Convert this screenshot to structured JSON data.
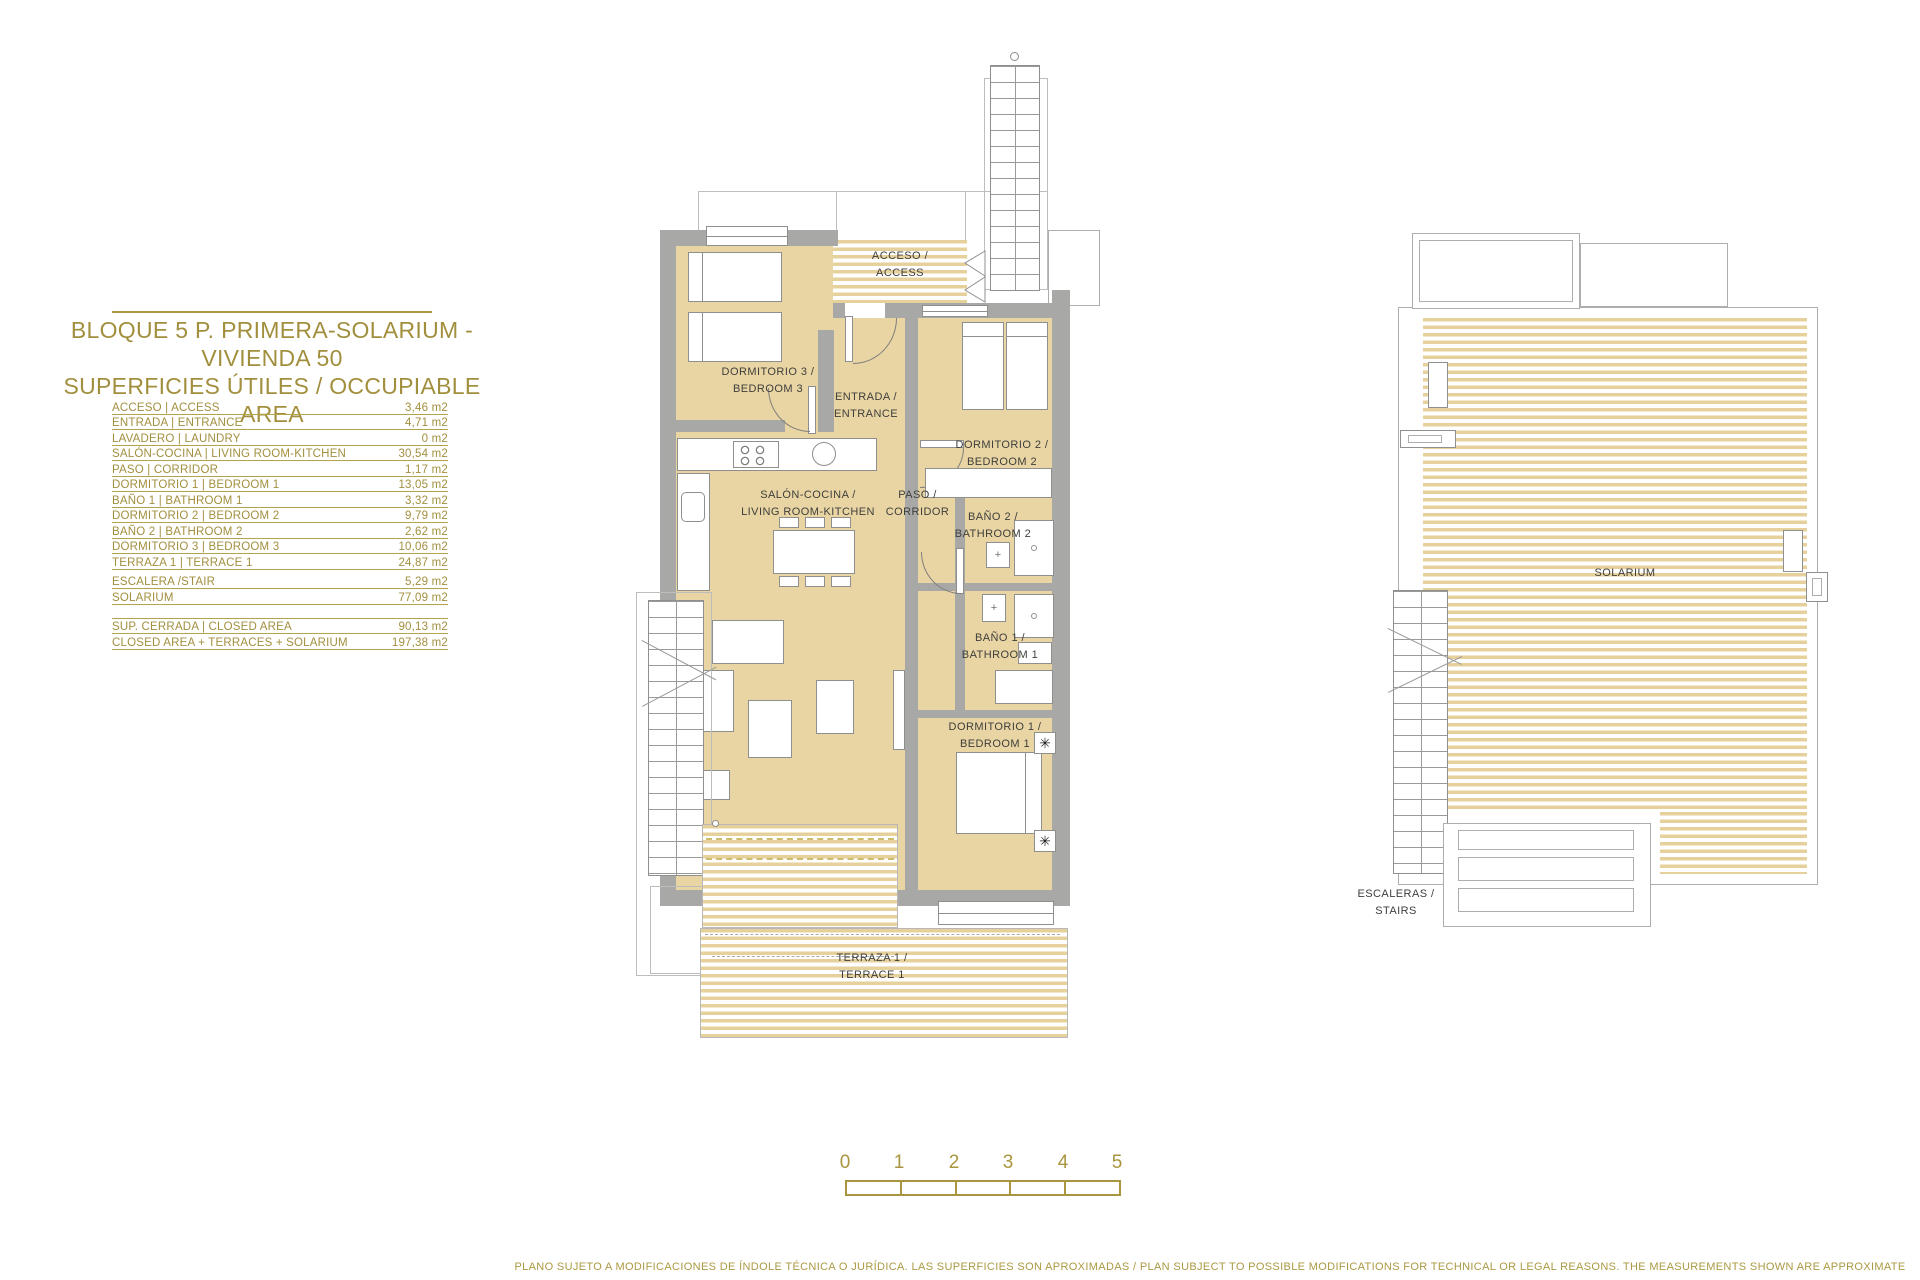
{
  "title": {
    "line1": "BLOQUE 5 P. PRIMERA-SOLARIUM - VIVIENDA 50",
    "line2": "SUPERFICIES ÚTILES / OCCUPIABLE AREA"
  },
  "area_table": {
    "rows": [
      {
        "label": "ACCESO | ACCESS",
        "value": "3,46 m2"
      },
      {
        "label": "ENTRADA | ENTRANCE",
        "value": "4,71 m2"
      },
      {
        "label": "LAVADERO | LAUNDRY",
        "value": "0 m2"
      },
      {
        "label": "SALÓN-COCINA | LIVING ROOM-KITCHEN",
        "value": "30,54 m2"
      },
      {
        "label": "PASO | CORRIDOR",
        "value": "1,17 m2"
      },
      {
        "label": "DORMITORIO 1 | BEDROOM 1",
        "value": "13,05 m2"
      },
      {
        "label": "BAÑO 1 | BATHROOM 1",
        "value": "3,32 m2"
      },
      {
        "label": "DORMITORIO 2 | BEDROOM 2",
        "value": "9,79 m2"
      },
      {
        "label": "BAÑO 2 | BATHROOM 2",
        "value": "2,62 m2"
      },
      {
        "label": "DORMITORIO 3 | BEDROOM 3",
        "value": "10,06 m2"
      },
      {
        "label": "TERRAZA 1 | TERRACE 1",
        "value": "24,87 m2"
      },
      {
        "label": "ESCALERA /STAIR",
        "value": "5,29 m2"
      },
      {
        "label": "SOLARIUM",
        "value": "77,09 m2"
      }
    ],
    "totals": [
      {
        "label": "SUP. CERRADA | CLOSED AREA",
        "value": "90,13 m2"
      },
      {
        "label": "CLOSED AREA + TERRACES + SOLARIUM",
        "value": "197,38 m2"
      }
    ]
  },
  "floor_plan": {
    "rooms": {
      "acceso": {
        "l1": "ACCESO /",
        "l2": "ACCESS"
      },
      "dormitorio3": {
        "l1": "DORMITORIO 3 /",
        "l2": "BEDROOM 3"
      },
      "entrada": {
        "l1": "ENTRADA /",
        "l2": "ENTRANCE"
      },
      "dormitorio2": {
        "l1": "DORMITORIO 2 /",
        "l2": "BEDROOM 2"
      },
      "salon": {
        "l1": "SALÓN-COCINA /",
        "l2": "LIVING ROOM-KITCHEN"
      },
      "paso": {
        "l1": "PASO /",
        "l2": "CORRIDOR"
      },
      "bano2": {
        "l1": "BAÑO 2 /",
        "l2": "BATHROOM 2"
      },
      "bano1": {
        "l1": "BAÑO 1 /",
        "l2": "BATHROOM 1"
      },
      "dormitorio1": {
        "l1": "DORMITORIO 1 /",
        "l2": "BEDROOM 1"
      },
      "terraza": {
        "l1": "TERRAZA 1 /",
        "l2": "TERRACE 1"
      }
    }
  },
  "solarium_plan": {
    "labels": {
      "solarium": "SOLARIUM",
      "escaleras": {
        "l1": "ESCALERAS /",
        "l2": "STAIRS"
      }
    }
  },
  "scale_bar": {
    "ticks": [
      "0",
      "1",
      "2",
      "3",
      "4",
      "5"
    ]
  },
  "disclaimer": "PLANO SUJETO A MODIFICACIONES DE ÍNDOLE TÉCNICA O JURÍDICA. LAS SUPERFICIES SON APROXIMADAS / PLAN SUBJECT TO POSSIBLE MODIFICATIONS FOR TECHNICAL OR LEGAL REASONS. THE MEASUREMENTS SHOWN ARE APPROXIMATE",
  "icons": {
    "fan": "✳",
    "sink_cross": "+"
  },
  "colors": {
    "accent_gold": "#a28f3e",
    "wall_gray": "#a8a8a6",
    "floor_tan": "#e9d5a3"
  }
}
